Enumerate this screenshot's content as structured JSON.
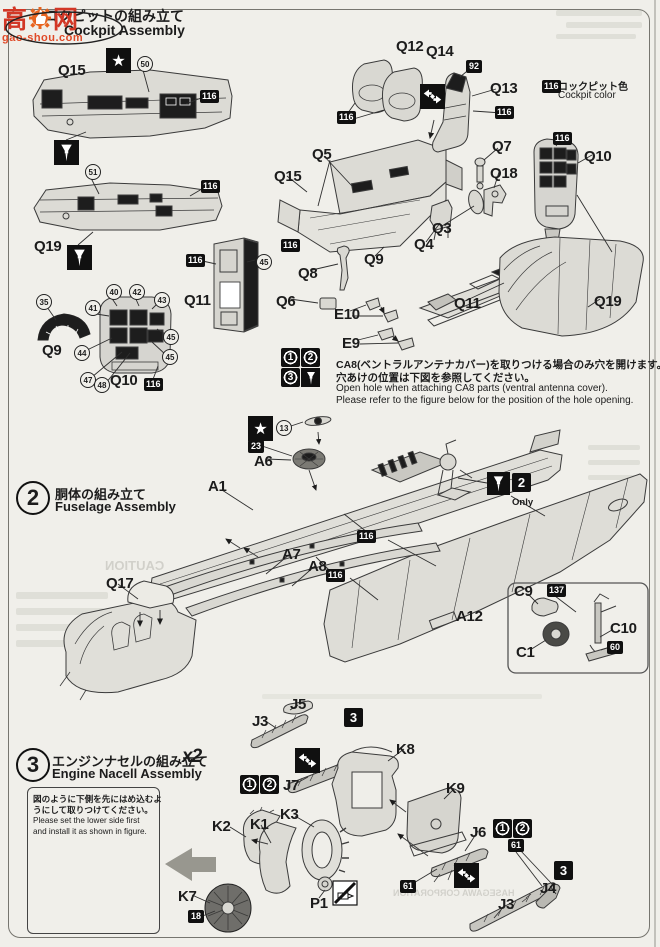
{
  "watermark": {
    "char1": "高",
    "char2": "网",
    "site": "gao-shou.com"
  },
  "header": {
    "title_jp": "コクピットの組み立て",
    "title_en": "Cockpit Assembly"
  },
  "legend": {
    "chip": "116",
    "jp": "コックピット色",
    "en": "Cockpit color"
  },
  "step2": {
    "num": "2",
    "jp": "胴体の組み立て",
    "en": "Fuselage Assembly"
  },
  "step3": {
    "num": "3",
    "jp": "エンジンナセルの組み立て",
    "en": "Engine Nacell Assembly",
    "qty": "x2"
  },
  "cab_note": {
    "jp1": "CA8(ベントラルアンテナカバー)を取りつける場合のみ穴を開けます。",
    "jp2": "穴あけの位置は下図を参照してください。",
    "en1": "Open hole when attaching CA8 parts (ventral antenna cover).",
    "en2": "Please refer to the figure below for the position of the hole opening."
  },
  "lower_note": {
    "jp1": "図のように下側を先にはめ込むよ",
    "jp2": "うにして取りつけてください。",
    "en1": "Please set the lower side first",
    "en2": "and install it as shown in figure."
  },
  "only_label": "Only",
  "ghost": {
    "caution": "CAUTION",
    "corp": "HASEGAWA CORPORATION"
  },
  "part_labels": [
    {
      "t": "Q15",
      "x": 58,
      "y": 62
    },
    {
      "t": "Q19",
      "x": 34,
      "y": 238
    },
    {
      "t": "Q11",
      "x": 184,
      "y": 292
    },
    {
      "t": "Q9",
      "x": 42,
      "y": 342
    },
    {
      "t": "Q10",
      "x": 110,
      "y": 372
    },
    {
      "t": "Q15",
      "x": 274,
      "y": 168
    },
    {
      "t": "Q5",
      "x": 312,
      "y": 146
    },
    {
      "t": "Q3",
      "x": 432,
      "y": 220
    },
    {
      "t": "Q4",
      "x": 414,
      "y": 236
    },
    {
      "t": "Q9",
      "x": 364,
      "y": 251
    },
    {
      "t": "Q8",
      "x": 298,
      "y": 265
    },
    {
      "t": "Q6",
      "x": 276,
      "y": 293
    },
    {
      "t": "E10",
      "x": 334,
      "y": 306
    },
    {
      "t": "E9",
      "x": 342,
      "y": 335
    },
    {
      "t": "Q7",
      "x": 492,
      "y": 138
    },
    {
      "t": "Q18",
      "x": 490,
      "y": 165
    },
    {
      "t": "Q11",
      "x": 454,
      "y": 295
    },
    {
      "t": "Q12",
      "x": 396,
      "y": 38
    },
    {
      "t": "Q14",
      "x": 426,
      "y": 43
    },
    {
      "t": "Q13",
      "x": 490,
      "y": 80
    },
    {
      "t": "Q10",
      "x": 584,
      "y": 148
    },
    {
      "t": "Q19",
      "x": 594,
      "y": 293
    },
    {
      "t": "A6",
      "x": 254,
      "y": 453
    },
    {
      "t": "A1",
      "x": 208,
      "y": 478
    },
    {
      "t": "A7",
      "x": 282,
      "y": 546
    },
    {
      "t": "A8",
      "x": 308,
      "y": 558
    },
    {
      "t": "Q17",
      "x": 106,
      "y": 575
    },
    {
      "t": "A12",
      "x": 456,
      "y": 608
    },
    {
      "t": "C9",
      "x": 514,
      "y": 583
    },
    {
      "t": "C10",
      "x": 610,
      "y": 620
    },
    {
      "t": "C1",
      "x": 516,
      "y": 644
    },
    {
      "t": "J3",
      "x": 252,
      "y": 713
    },
    {
      "t": "J5",
      "x": 290,
      "y": 696
    },
    {
      "t": "J7",
      "x": 283,
      "y": 777
    },
    {
      "t": "K8",
      "x": 396,
      "y": 741
    },
    {
      "t": "K9",
      "x": 446,
      "y": 780
    },
    {
      "t": "K2",
      "x": 212,
      "y": 818
    },
    {
      "t": "K1",
      "x": 250,
      "y": 816
    },
    {
      "t": "K3",
      "x": 280,
      "y": 806
    },
    {
      "t": "K7",
      "x": 178,
      "y": 888
    },
    {
      "t": "P1",
      "x": 310,
      "y": 895
    },
    {
      "t": "J6",
      "x": 470,
      "y": 824
    },
    {
      "t": "J4",
      "x": 540,
      "y": 880
    },
    {
      "t": "J3",
      "x": 498,
      "y": 896
    }
  ],
  "paint_chips": [
    {
      "t": "116",
      "x": 200,
      "y": 90
    },
    {
      "t": "116",
      "x": 201,
      "y": 180
    },
    {
      "t": "116",
      "x": 186,
      "y": 254
    },
    {
      "t": "116",
      "x": 144,
      "y": 378
    },
    {
      "t": "116",
      "x": 281,
      "y": 239
    },
    {
      "t": "116",
      "x": 337,
      "y": 111
    },
    {
      "t": "92",
      "x": 466,
      "y": 60
    },
    {
      "t": "116",
      "x": 495,
      "y": 106
    },
    {
      "t": "116",
      "x": 553,
      "y": 132
    },
    {
      "t": "23",
      "x": 248,
      "y": 440
    },
    {
      "t": "116",
      "x": 357,
      "y": 530
    },
    {
      "t": "116",
      "x": 326,
      "y": 569
    },
    {
      "t": "137",
      "x": 547,
      "y": 584
    },
    {
      "t": "60",
      "x": 607,
      "y": 641
    },
    {
      "t": "18",
      "x": 188,
      "y": 910
    },
    {
      "t": "61",
      "x": 400,
      "y": 880
    },
    {
      "t": "61",
      "x": 508,
      "y": 839
    }
  ],
  "decal_circles": [
    {
      "t": "50",
      "x": 137,
      "y": 56
    },
    {
      "t": "51",
      "x": 85,
      "y": 164
    },
    {
      "t": "45",
      "x": 256,
      "y": 254
    },
    {
      "t": "35",
      "x": 36,
      "y": 294
    },
    {
      "t": "41",
      "x": 85,
      "y": 300
    },
    {
      "t": "40",
      "x": 106,
      "y": 284
    },
    {
      "t": "42",
      "x": 129,
      "y": 284
    },
    {
      "t": "43",
      "x": 154,
      "y": 292
    },
    {
      "t": "44",
      "x": 74,
      "y": 345
    },
    {
      "t": "45",
      "x": 163,
      "y": 329
    },
    {
      "t": "45",
      "x": 162,
      "y": 349
    },
    {
      "t": "47",
      "x": 80,
      "y": 372
    },
    {
      "t": "48",
      "x": 94,
      "y": 377
    },
    {
      "t": "13",
      "x": 276,
      "y": 420
    }
  ],
  "sq_digits": [
    {
      "d": "1",
      "x": 281,
      "y": 348,
      "ring": true
    },
    {
      "d": "2",
      "x": 301,
      "y": 348,
      "ring": true
    },
    {
      "d": "3",
      "x": 281,
      "y": 368,
      "ring": true
    },
    {
      "d": "1",
      "x": 240,
      "y": 775,
      "ring": true
    },
    {
      "d": "2",
      "x": 260,
      "y": 775,
      "ring": true
    },
    {
      "d": "1",
      "x": 493,
      "y": 819,
      "ring": true
    },
    {
      "d": "2",
      "x": 513,
      "y": 819,
      "ring": true
    },
    {
      "d": "3",
      "x": 344,
      "y": 708
    },
    {
      "d": "3",
      "x": 554,
      "y": 861
    },
    {
      "d": "2",
      "x": 512,
      "y": 473
    }
  ]
}
